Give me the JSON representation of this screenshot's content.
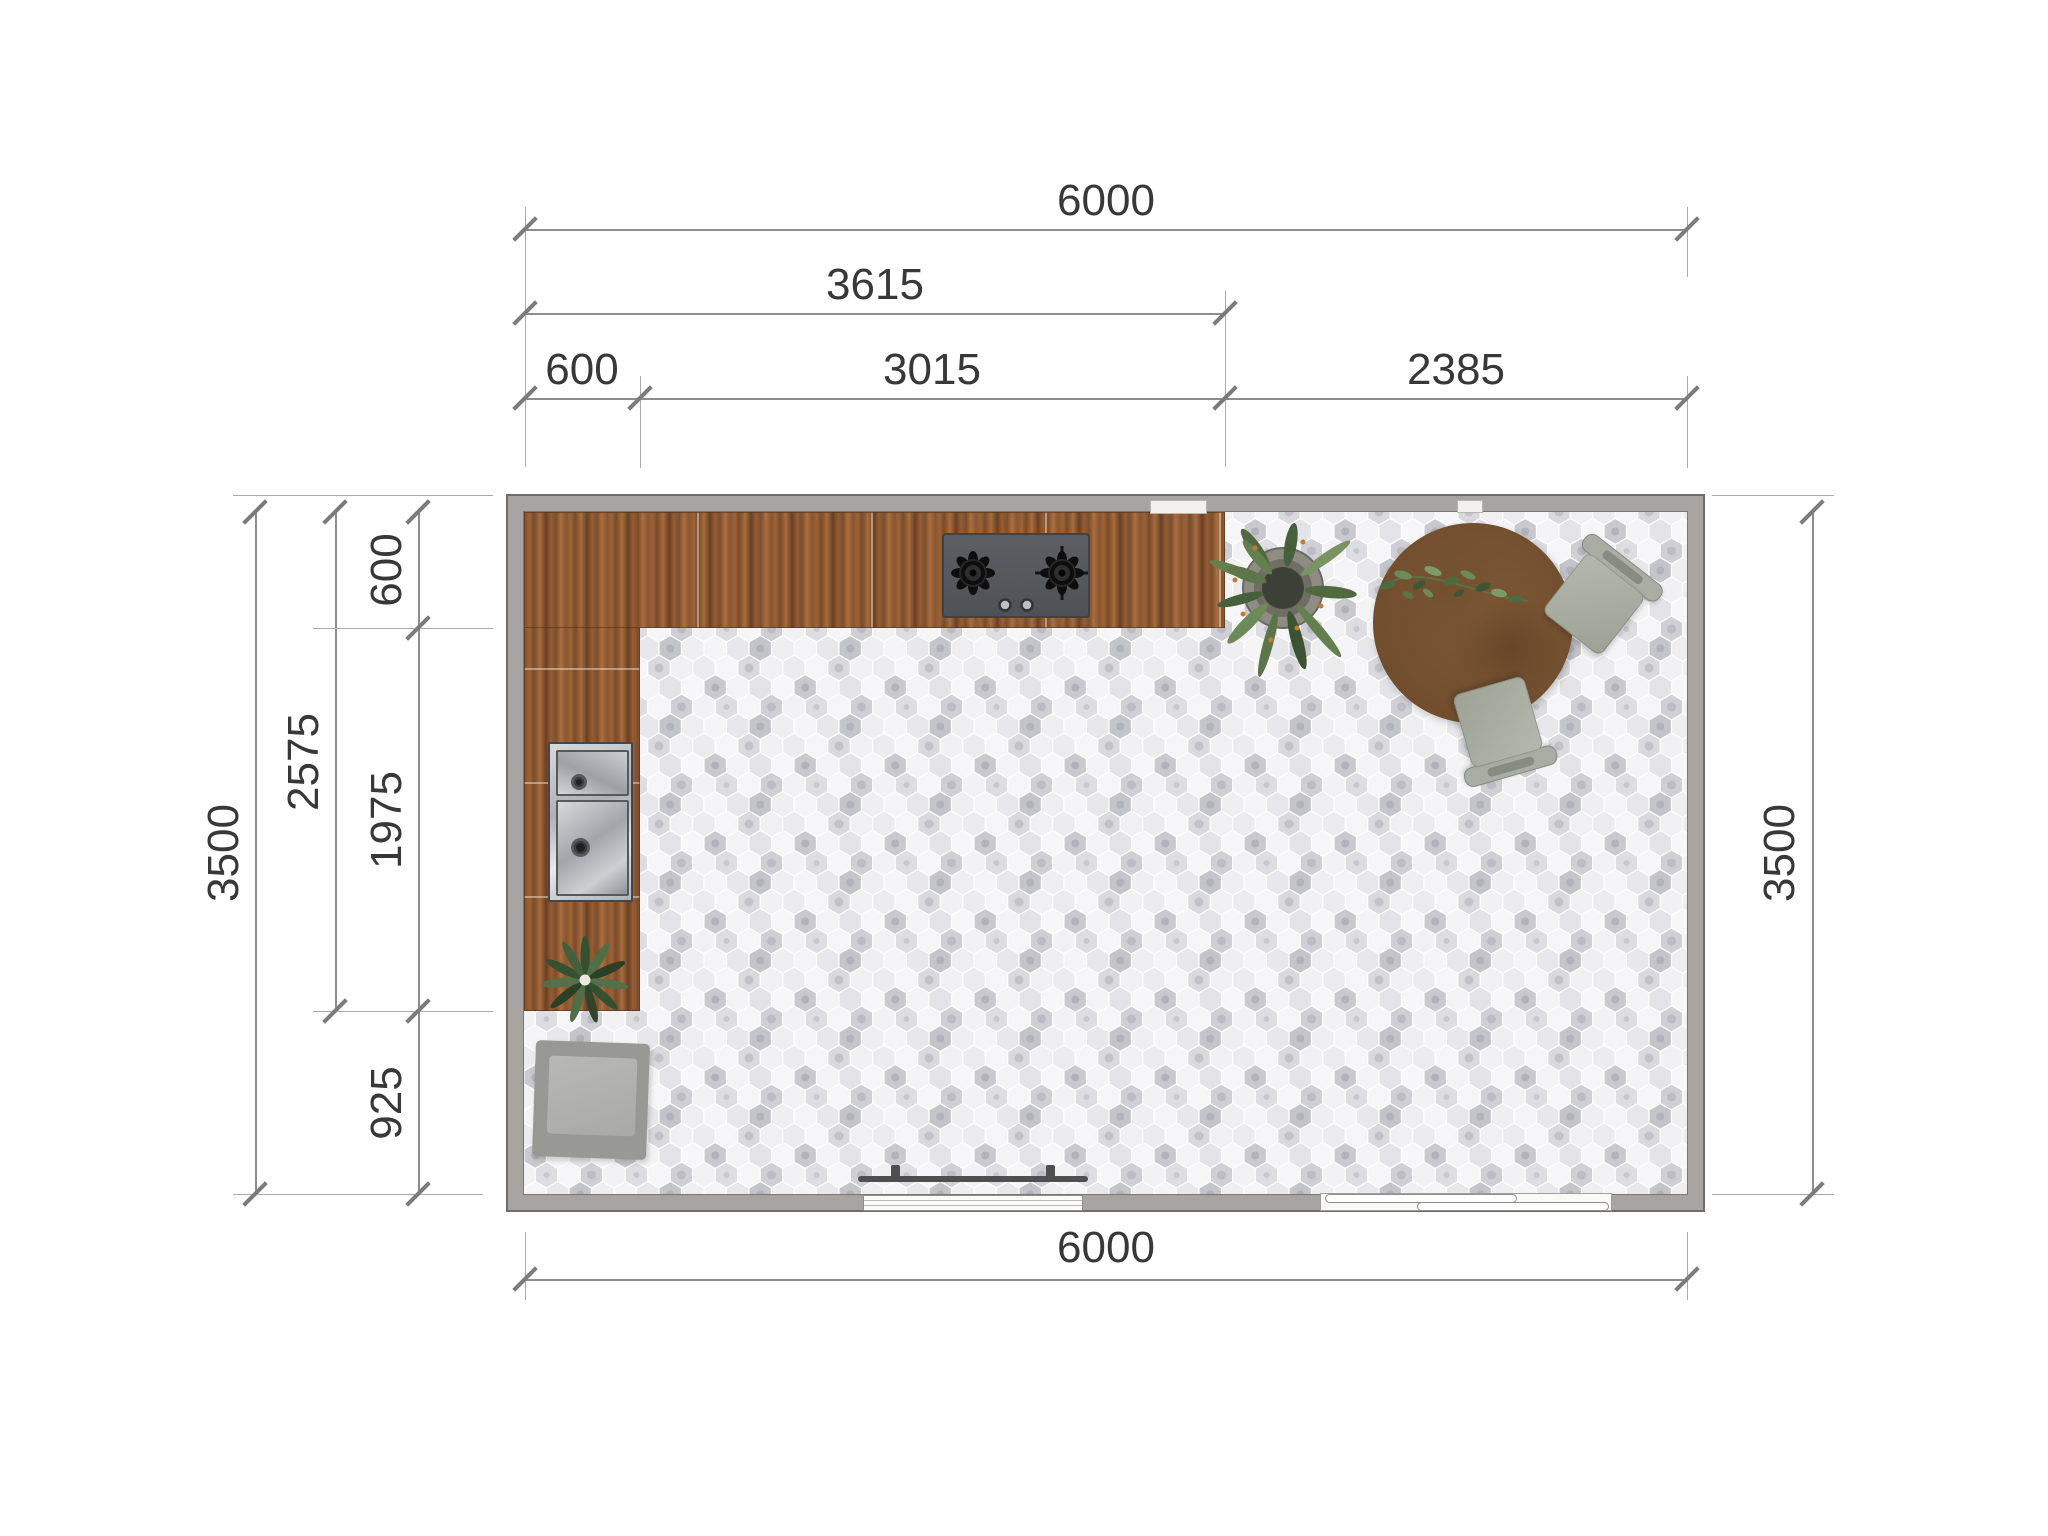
{
  "plan_type": "kitchen-floor-plan-top-view",
  "dims": {
    "top_total": "6000",
    "top_3615": "3615",
    "top_600": "600",
    "top_3015": "3015",
    "top_2385": "2385",
    "left_3500": "3500",
    "left_2575": "2575",
    "left_600": "600",
    "left_1975": "1975",
    "left_925": "925",
    "right_3500": "3500",
    "bottom_6000": "6000"
  },
  "room": {
    "width_mm": 6000,
    "depth_mm": 3500
  },
  "objects": [
    "l-shaped-wood-counter",
    "gas-cooktop-2-burner",
    "double-bowl-stainless-sink",
    "counter-plant",
    "potted-plant",
    "round-dining-table",
    "dining-chair-upper",
    "dining-chair-lower",
    "cube-armchair",
    "window",
    "curtain-rod",
    "sliding-door",
    "wall-vent"
  ],
  "palette": {
    "wall": "#a7a4a2",
    "wall_outline": "#6f6d6b",
    "counter_wood": "#8a5530",
    "cooktop": "#54585c",
    "sink_steel": "#c9cdd1",
    "floor_tile_light": "#f4f4f6",
    "floor_tile_dark": "#c6c6cb",
    "table_wood": "#7a5433",
    "chair_gray": "#a8aca2",
    "armchair_gray": "#989894",
    "plant_green": "#5c7a4e",
    "dim_line": "#8d8d8d",
    "dim_text": "#383838"
  }
}
